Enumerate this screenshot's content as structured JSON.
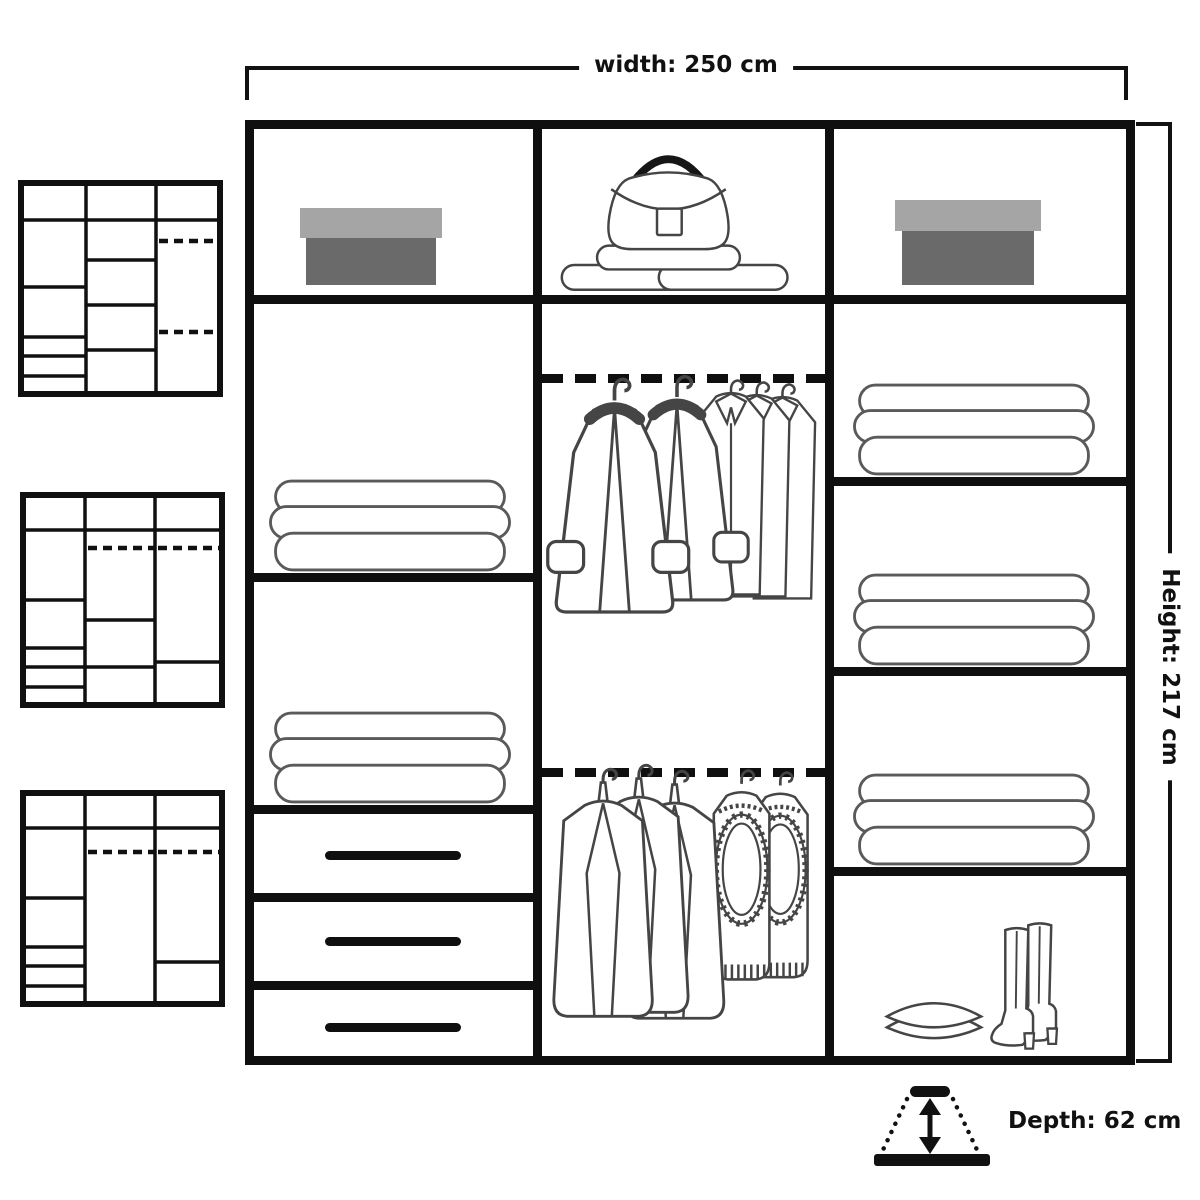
{
  "dimensions": {
    "width_label": "width: 250 cm",
    "height_label": "Height: 217 cm",
    "depth_label": "Depth: 62 cm",
    "width_cm": 250,
    "height_cm": 217,
    "depth_cm": 62
  },
  "colors": {
    "structure_line": "#0f0f0f",
    "garment_line": "#454545",
    "shoebox_lid": "#a5a5a5",
    "shoebox_base": "#6a6a6a",
    "background": "#ffffff"
  },
  "wardrobe": {
    "columns": [
      {
        "id": "left",
        "sections": [
          "shelf with shoe box",
          "shelf with folded clothes",
          "shelf with folded clothes",
          "drawer",
          "drawer",
          "drawer"
        ]
      },
      {
        "id": "middle",
        "sections": [
          "shelf with handbag and folded clothes",
          "hanging rail with coats and shirts",
          "hanging rail with jackets and knit vests"
        ]
      },
      {
        "id": "right",
        "sections": [
          "shelf with shoe box",
          "shelf with folded clothes",
          "shelf with folded clothes",
          "shelf with folded clothes",
          "compartment with pillows and boots"
        ]
      }
    ]
  },
  "thumbnails": [
    {
      "id": "layout-option-1",
      "description": "alternative layout: drawers left, shelves middle, two hanging rails right"
    },
    {
      "id": "layout-option-2",
      "description": "alternative layout: hanging rails in middle and right columns"
    },
    {
      "id": "layout-option-3",
      "description": "alternative layout: full-height hanging space in middle column"
    }
  ]
}
